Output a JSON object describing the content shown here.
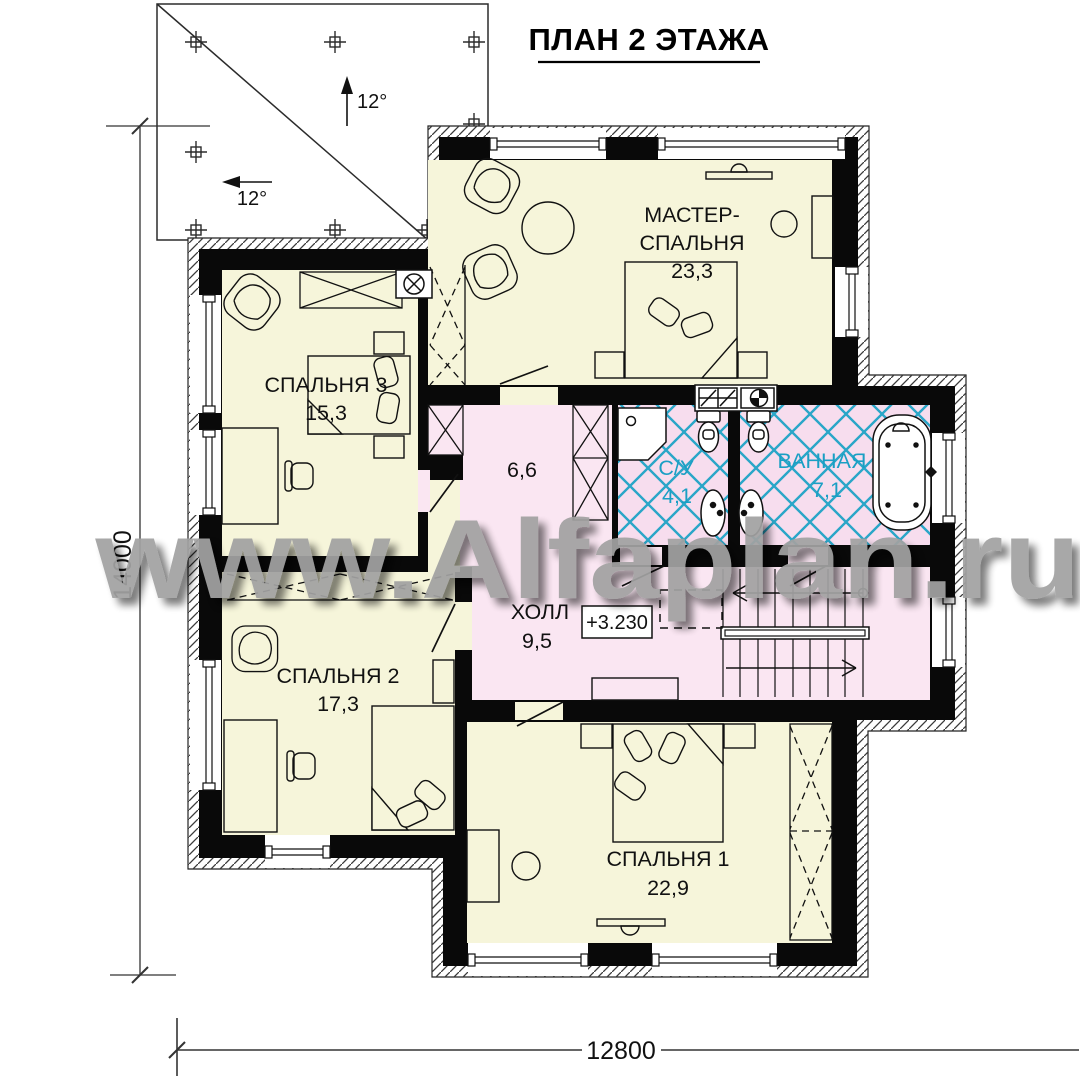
{
  "title": "ПЛАН 2 ЭТАЖА",
  "watermark": "www.Alfaplan.ru",
  "roof": {
    "slope_up": "12°",
    "slope_left": "12°"
  },
  "dims": {
    "height": "14000",
    "width": "12800"
  },
  "elevation": "+3.230",
  "rooms": {
    "master": {
      "line1": "МАСТЕР-",
      "line2": "СПАЛЬНЯ",
      "area": "23,3"
    },
    "bedroom3": {
      "name": "СПАЛЬНЯ 3",
      "area": "15,3"
    },
    "bedroom2": {
      "name": "СПАЛЬНЯ 2",
      "area": "17,3"
    },
    "bedroom1": {
      "name": "СПАЛЬНЯ 1",
      "area": "22,9"
    },
    "hall": {
      "name": "ХОЛЛ",
      "area": "9,5"
    },
    "corridor": {
      "area": "6,6"
    },
    "wc": {
      "name": "С/У",
      "area": "4,1"
    },
    "bath": {
      "name": "ВАННАЯ",
      "area": "7,1"
    }
  },
  "colors": {
    "room_cream": "#f6f5da",
    "room_pink": "#fae6f2",
    "tile_cyan": "#2aa6c8",
    "wall_black": "#090909",
    "watermark_gray": "#a2a2a2"
  }
}
